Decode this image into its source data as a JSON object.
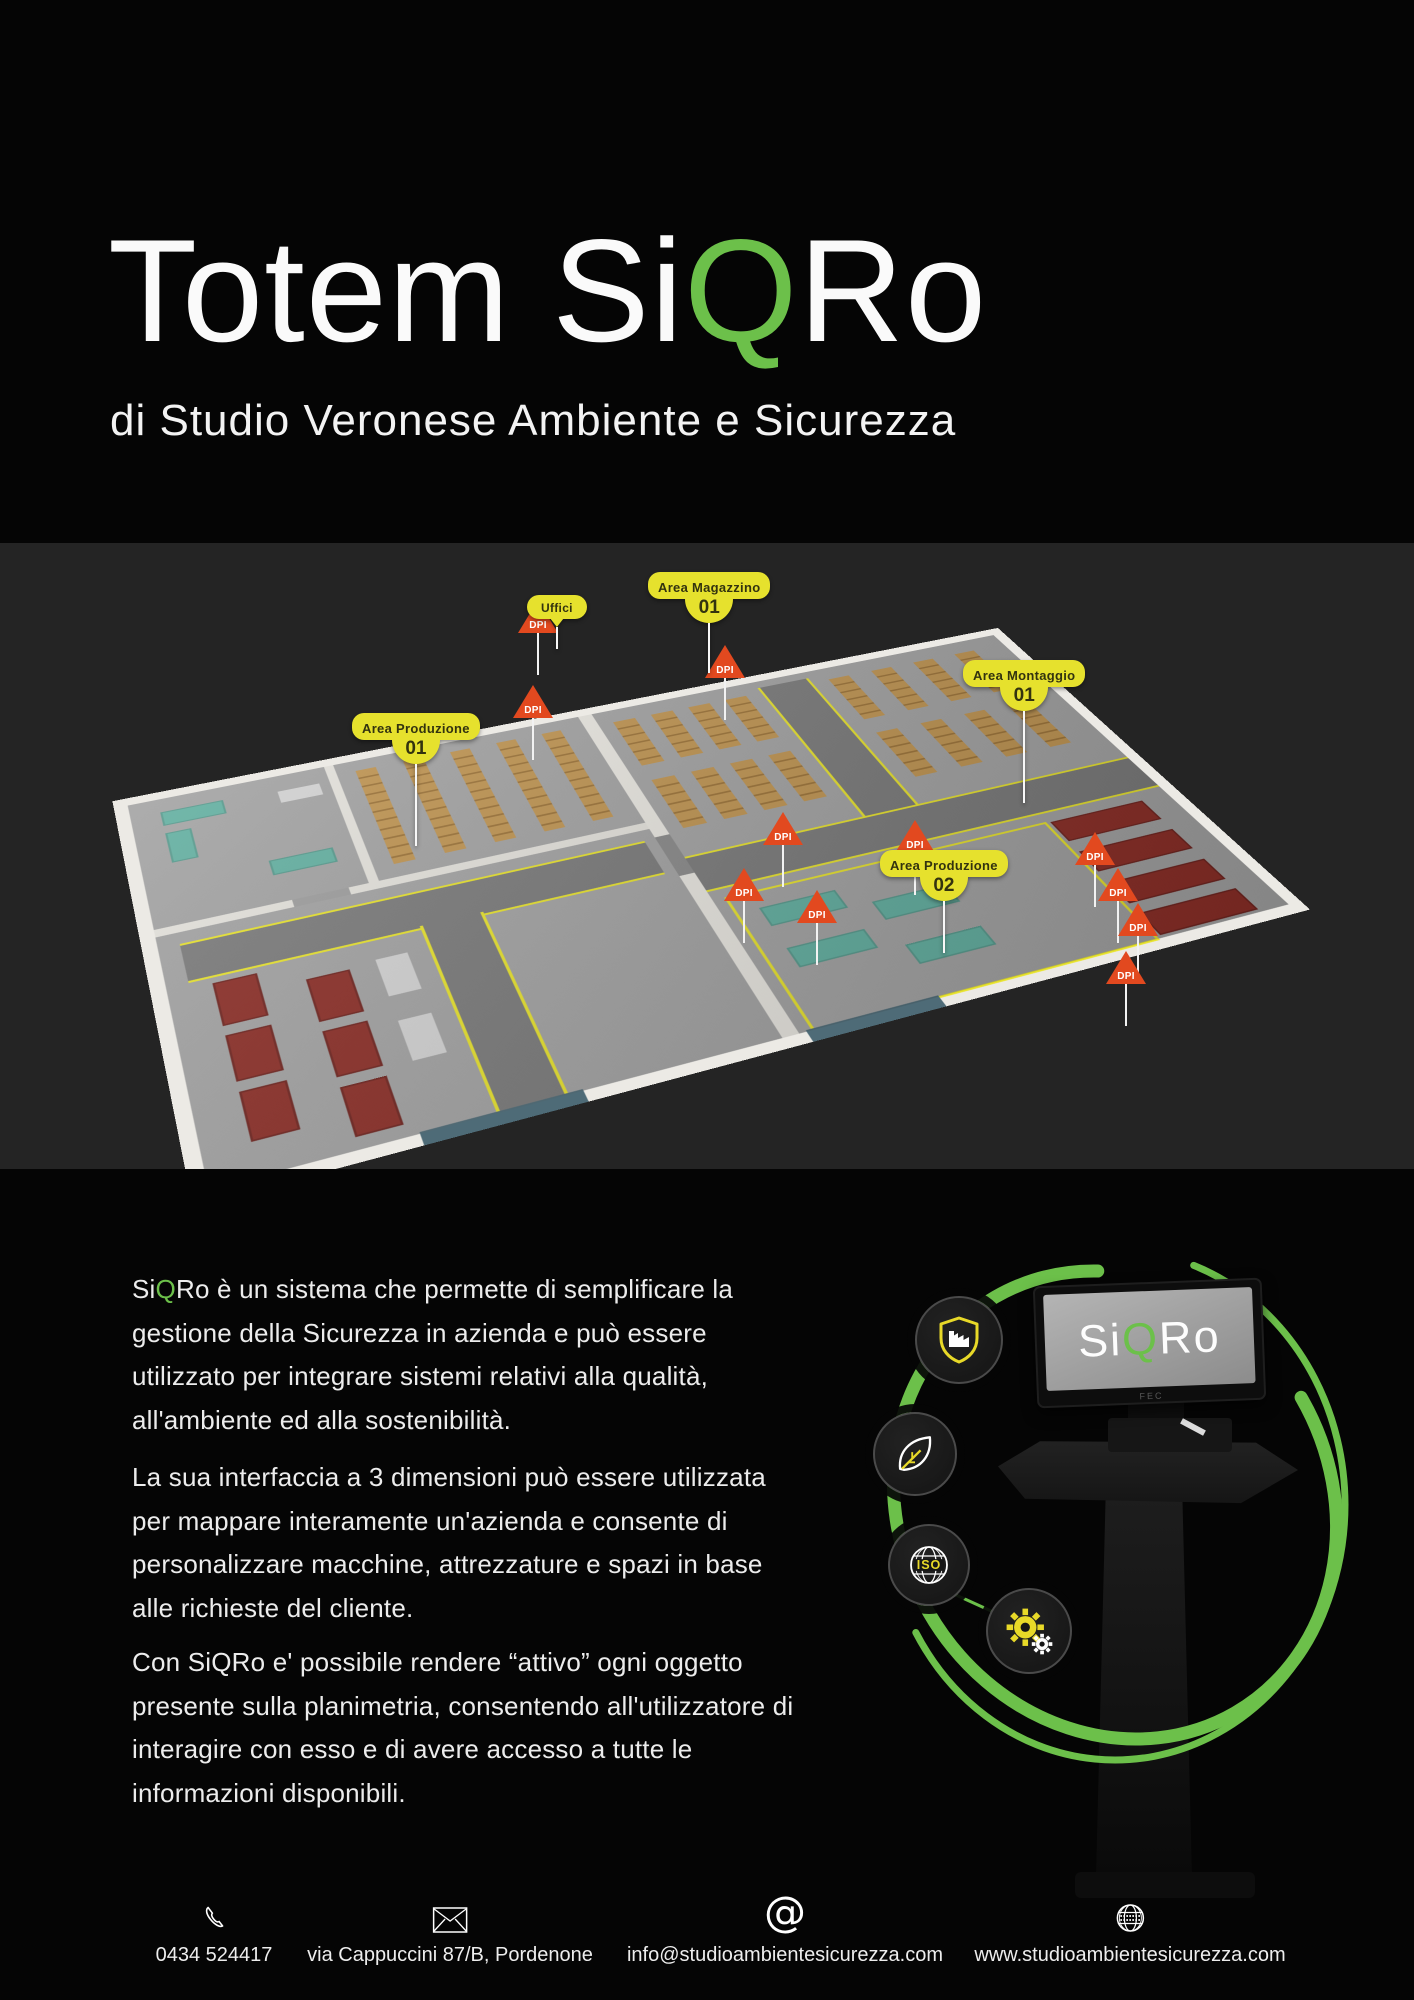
{
  "header": {
    "title_pre": "Totem Si",
    "title_q": "Q",
    "title_post": "Ro",
    "subtitle": "di Studio Veronese Ambiente e Sicurezza"
  },
  "floorplan": {
    "area_labels": [
      {
        "line1": "Uffici",
        "line2": ""
      },
      {
        "line1": "Area Magazzino",
        "line2": "01"
      },
      {
        "line1": "Area Montaggio",
        "line2": "01"
      },
      {
        "line1": "Area Produzione",
        "line2": "01"
      },
      {
        "line1": "Area Produzione",
        "line2": "02"
      }
    ],
    "dpi_label": "DPI",
    "dpi_pins": [
      {
        "x": 538,
        "y": 57
      },
      {
        "x": 533,
        "y": 142
      },
      {
        "x": 725,
        "y": 102
      },
      {
        "x": 783,
        "y": 269
      },
      {
        "x": 744,
        "y": 325
      },
      {
        "x": 817,
        "y": 347
      },
      {
        "x": 915,
        "y": 277
      },
      {
        "x": 1095,
        "y": 289
      },
      {
        "x": 1118,
        "y": 325
      },
      {
        "x": 1138,
        "y": 360
      },
      {
        "x": 1126,
        "y": 408
      }
    ]
  },
  "body": {
    "p1_pre": "Si",
    "p1_q": "Q",
    "p1_post": "Ro è un sistema che permette di semplificare la\ngestione della Sicurezza in azienda e può essere\nutilizzato per integrare sistemi relativi alla qualità,\nall'ambiente ed alla sostenibilità.",
    "p2": "La sua interfaccia a 3 dimensioni può essere utilizzata\nper mappare interamente un'azienda e consente di\npersonalizzare macchine, attrezzature e spazi in base\nalle richieste del cliente.",
    "p3": "Con SiQRo e' possibile rendere “attivo” ogni oggetto\npresente sulla planimetria, consentendo all'utilizzatore di\ninteragire con esso e di avere accesso a tutte le\ninformazioni disponibili."
  },
  "kiosk": {
    "screen_pre": "Si",
    "screen_q": "Q",
    "screen_post": "Ro",
    "brand": "FEC",
    "iso_text": "ISO"
  },
  "footer": {
    "items": [
      {
        "icon": "phone-icon",
        "text": "0434 524417"
      },
      {
        "icon": "envelope-icon",
        "text": "via Cappuccini 87/B, Pordenone"
      },
      {
        "icon": "at-icon",
        "text": "info@studioambientesicurezza.com"
      },
      {
        "icon": "globe-icon",
        "text": "www.studioambientesicurezza.com"
      }
    ]
  },
  "colors": {
    "accent_green": "#6cc04a",
    "label_yellow": "#e6e12d",
    "dpi_orange": "#e2491f"
  }
}
